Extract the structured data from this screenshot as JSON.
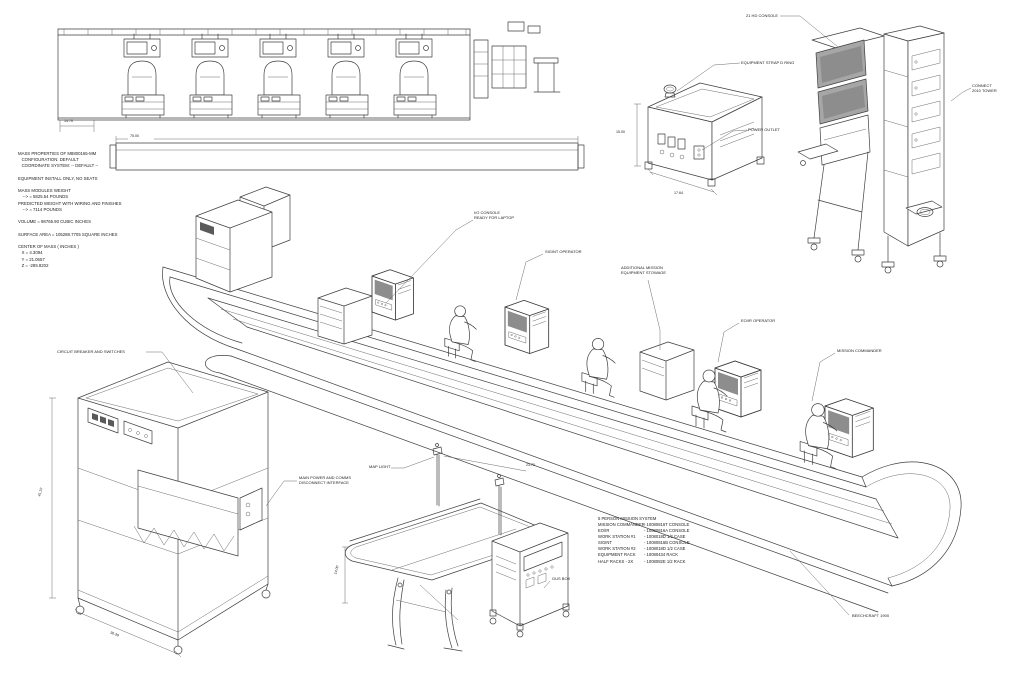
{
  "sheet": {
    "background": "#ffffff",
    "ink": "#3f3f3f"
  },
  "mass_properties": {
    "lines": [
      "MASS PROPERTIES OF M8800165-MM",
      "   CONFIGURATION: DEFAULT",
      "   COORDINATE SYSTEM: -- DEFAULT --",
      "",
      "EQUIPMENT INSTALL ONLY, NO SEATS",
      "",
      "MASS MODULES WEIGHT",
      "    --> = 5825.54 POUNDS",
      "PREDICTED WEIGHT WITH WIRING AND FINISHES",
      "    --> = 7114 POUNDS",
      "",
      "VOLUME = 98765.90 CUBIC INCHES",
      "",
      "SURFACE AREA = 105288.7705 SQUARE INCHES",
      "",
      "CENTER OF MASS ( INCHES )",
      "   X = 4.3094",
      "   Y = 21.0657",
      "   Z = -285.8202"
    ]
  },
  "callouts": {
    "hd_console": "21 HD CONSOLE",
    "connect_tower": "CONNECT\n2010 TOWER",
    "equipment_strap": "EQUIPMENT STRAP D RING",
    "power_outlet": "POWER OUTLET",
    "io_console": "I/O CONSOLE\nREADY FOR LAPTOP",
    "sigint_operator": "SIGINT OPERATOR",
    "additional_stowage": "ADDITIONAL MISSION\nEQUIPMENT STOWAGE",
    "eoir_operator": "EO/IR OPERATOR",
    "mission_commander": "MISSION COMMANDER",
    "circuit_breaker": "CIRCUIT BREAKER AND SWITCHES",
    "main_power": "MAIN POWER AND COMMS\nDISCONNECT INTERFACE",
    "map_light": "MAP LIGHT",
    "gus_box": "GUS BOX",
    "beechcraft": "BEECHCRAFT 1900"
  },
  "dimensions": {
    "elevation_pitch": "14.70",
    "elevation_span": "75.00",
    "box_height": "15.00",
    "box_width": "17.64",
    "rack_height": "41.37",
    "rack_width": "30.39",
    "table_height": "14.00",
    "table_span": "23.70"
  },
  "parts_list": {
    "title": "5 PERSON MISSION SYSTEM",
    "rows": [
      {
        "item": "MISSION COMMANDER",
        "part": "- 10080816T CONSOLE"
      },
      {
        "item": "EO/IR",
        "part": "- 10080816A CONSOLE"
      },
      {
        "item": "WORK STATION #1",
        "part": "- 1008018D 1/2 CASE"
      },
      {
        "item": "SIGINT",
        "part": "- 10080816B CONSOLE"
      },
      {
        "item": "WORK STATION #2",
        "part": "- 1008018D 1/2 CASE"
      },
      {
        "item": "EQUIPMENT RACK",
        "part": "- 10080434 RACK"
      },
      {
        "item": "HALF RACKS - 2X",
        "part": "- 1008082E 1/2 RACK"
      }
    ]
  }
}
